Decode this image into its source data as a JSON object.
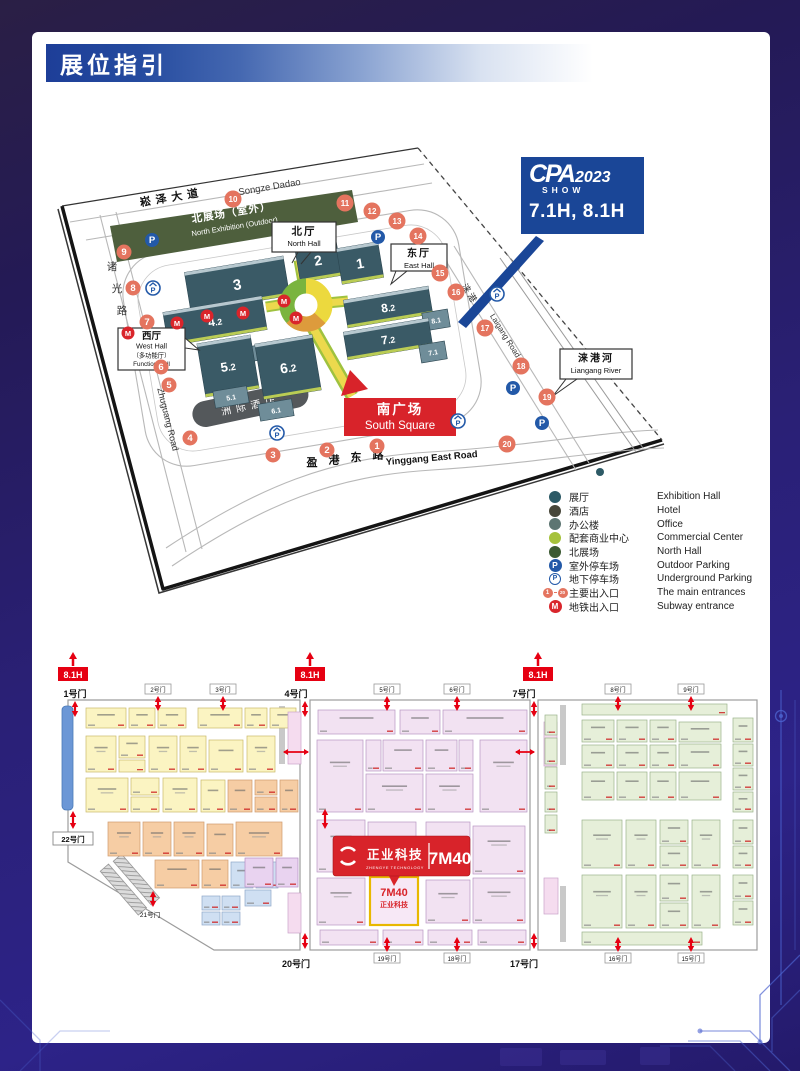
{
  "header": {
    "title": "展位指引"
  },
  "badge": {
    "brand": "CPA",
    "year": "2023",
    "show": "SHOW",
    "halls": "7.1H, 8.1H",
    "bg": "#1a4697"
  },
  "map": {
    "roads": {
      "songze_cn": "崧泽大道",
      "songze_en": "Songze Dadao",
      "zhuguang_cn": "诸光路",
      "zhuguang_en": "Zhuguang Road",
      "yinggang_cn": "盈港东路",
      "yinggang_en": "Yinggang East Road",
      "laigang_cn": "涞港路",
      "laigang_en": "Laigang Road"
    },
    "green_area": {
      "cn": "北展场（室外）",
      "en": "North Exhibition (Outdoor)"
    },
    "hotel": {
      "name": "洲际酒店"
    },
    "halls": [
      {
        "label": "3",
        "cx": 237,
        "cy": 284,
        "w": 100,
        "h": 40,
        "fs": 15,
        "small": false
      },
      {
        "label": "4.2",
        "cx": 215,
        "cy": 321,
        "w": 100,
        "h": 34,
        "fs": 12,
        "small": false
      },
      {
        "label": "4.1",
        "cx": 263,
        "cy": 352,
        "w": 40,
        "h": 15,
        "fs": 7,
        "small": true
      },
      {
        "label": "2",
        "cx": 318,
        "cy": 260,
        "w": 42,
        "h": 38,
        "fs": 14,
        "small": false
      },
      {
        "label": "1",
        "cx": 360,
        "cy": 263,
        "w": 42,
        "h": 36,
        "fs": 14,
        "small": false
      },
      {
        "label": "8.2",
        "cx": 388,
        "cy": 307,
        "w": 86,
        "h": 28,
        "fs": 12,
        "small": false
      },
      {
        "label": "8.1",
        "cx": 436,
        "cy": 320,
        "w": 26,
        "h": 18,
        "fs": 7,
        "small": true
      },
      {
        "label": "7.2",
        "cx": 388,
        "cy": 339,
        "w": 86,
        "h": 28,
        "fs": 12,
        "small": false
      },
      {
        "label": "7.1",
        "cx": 433,
        "cy": 352,
        "w": 26,
        "h": 18,
        "fs": 7,
        "small": true
      },
      {
        "label": "5.2",
        "cx": 228,
        "cy": 366,
        "w": 54,
        "h": 54,
        "fs": 13,
        "small": false
      },
      {
        "label": "6.2",
        "cx": 288,
        "cy": 367,
        "w": 58,
        "h": 56,
        "fs": 14,
        "small": false
      },
      {
        "label": "5.1",
        "cx": 231,
        "cy": 397,
        "w": 34,
        "h": 17,
        "fs": 7,
        "small": true
      },
      {
        "label": "6.1",
        "cx": 276,
        "cy": 410,
        "w": 34,
        "h": 17,
        "fs": 7,
        "small": true
      }
    ],
    "callouts": [
      {
        "id": "north",
        "cn": "北厅",
        "en": "North Hall",
        "x": 272,
        "y": 222,
        "w": 64,
        "h": 30
      },
      {
        "id": "east",
        "cn": "东厅",
        "en": "East Hall",
        "x": 391,
        "y": 244,
        "w": 56,
        "h": 27
      },
      {
        "id": "west",
        "cn": "西厅",
        "en": "West Hall",
        "sub_cn": "（多功能厅）",
        "sub_en": "Function Hall",
        "x": 118,
        "y": 328,
        "w": 67,
        "h": 42
      },
      {
        "id": "river",
        "cn": "涞港河",
        "en": "Liangang River",
        "x": 560,
        "y": 349,
        "w": 72,
        "h": 30
      }
    ],
    "south_square": {
      "cn": "南广场",
      "en": "South Square",
      "x": 344,
      "y": 398,
      "w": 112,
      "h": 38
    },
    "entrances": [
      {
        "n": "1",
        "x": 377,
        "y": 446
      },
      {
        "n": "2",
        "x": 327,
        "y": 450
      },
      {
        "n": "3",
        "x": 273,
        "y": 455
      },
      {
        "n": "4",
        "x": 190,
        "y": 438
      },
      {
        "n": "5",
        "x": 169,
        "y": 385
      },
      {
        "n": "6",
        "x": 161,
        "y": 367
      },
      {
        "n": "7",
        "x": 147,
        "y": 322
      },
      {
        "n": "8",
        "x": 133,
        "y": 288
      },
      {
        "n": "9",
        "x": 124,
        "y": 252
      },
      {
        "n": "10",
        "x": 233,
        "y": 199
      },
      {
        "n": "11",
        "x": 345,
        "y": 203
      },
      {
        "n": "12",
        "x": 372,
        "y": 211
      },
      {
        "n": "13",
        "x": 397,
        "y": 221
      },
      {
        "n": "14",
        "x": 418,
        "y": 236
      },
      {
        "n": "15",
        "x": 440,
        "y": 273
      },
      {
        "n": "16",
        "x": 456,
        "y": 292
      },
      {
        "n": "17",
        "x": 485,
        "y": 328
      },
      {
        "n": "18",
        "x": 521,
        "y": 366
      },
      {
        "n": "19",
        "x": 547,
        "y": 397
      },
      {
        "n": "20",
        "x": 507,
        "y": 444
      }
    ],
    "parking_outdoor": [
      [
        152,
        240
      ],
      [
        378,
        237
      ],
      [
        513,
        388
      ],
      [
        542,
        423
      ]
    ],
    "parking_underground": [
      [
        153,
        288
      ],
      [
        277,
        433
      ],
      [
        458,
        421
      ],
      [
        497,
        294
      ]
    ],
    "subway_points": [
      [
        128,
        333
      ],
      [
        177,
        323
      ],
      [
        207,
        316
      ],
      [
        243,
        313
      ],
      [
        284,
        301
      ],
      [
        296,
        318
      ]
    ]
  },
  "legend": {
    "rows": [
      {
        "icon": "dot",
        "color": "#2d5a66",
        "cn": "展厅",
        "en": "Exhibition Hall"
      },
      {
        "icon": "dot",
        "color": "#474639",
        "cn": "酒店",
        "en": "Hotel"
      },
      {
        "icon": "dot",
        "color": "#5d7572",
        "cn": "办公楼",
        "en": "Office"
      },
      {
        "icon": "dot",
        "color": "#a6c23c",
        "cn": "配套商业中心",
        "en": "Commercial Center"
      },
      {
        "icon": "dot",
        "color": "#3c5a33",
        "cn": "北展场",
        "en": "North Hall"
      },
      {
        "icon": "p-solid",
        "color": "#2359a8",
        "cn": "室外停车场",
        "en": "Outdoor Parking"
      },
      {
        "icon": "p-under",
        "color": "#2359a8",
        "cn": "地下停车场",
        "en": "Underground Parking"
      },
      {
        "icon": "entrance",
        "color": "#e4745f",
        "from": "1",
        "to": "20",
        "cn": "主要出入口",
        "en": "The main entrances"
      },
      {
        "icon": "subway",
        "color": "#d9252b",
        "glyph": "M",
        "cn": "地铁出入口",
        "en": "Subway entrance"
      }
    ]
  },
  "floorplan": {
    "hall_markers": [
      {
        "label": "8.1H",
        "x": 58
      },
      {
        "label": "8.1H",
        "x": 295
      },
      {
        "label": "8.1H",
        "x": 523
      }
    ],
    "gates": [
      {
        "label": "1号门",
        "x": 75,
        "big": true,
        "side": "top",
        "ax": 75
      },
      {
        "label": "2号门",
        "x": 158,
        "big": false,
        "side": "top"
      },
      {
        "label": "3号门",
        "x": 223,
        "big": false,
        "side": "top"
      },
      {
        "label": "4号门",
        "x": 296,
        "big": true,
        "side": "top",
        "ax": 305
      },
      {
        "label": "5号门",
        "x": 387,
        "big": false,
        "side": "top"
      },
      {
        "label": "6号门",
        "x": 457,
        "big": false,
        "side": "top"
      },
      {
        "label": "7号门",
        "x": 524,
        "big": true,
        "side": "top",
        "ax": 534
      },
      {
        "label": "8号门",
        "x": 618,
        "big": false,
        "side": "top"
      },
      {
        "label": "9号门",
        "x": 691,
        "big": false,
        "side": "top"
      },
      {
        "label": "22号门",
        "x": 73,
        "big": true,
        "side": "left",
        "ax": 73
      },
      {
        "label": "21号门",
        "x": 150,
        "big": false,
        "side": "diag",
        "ax": 153
      },
      {
        "label": "20号门",
        "x": 296,
        "big": true,
        "side": "bottom",
        "ax": 305
      },
      {
        "label": "19号门",
        "x": 387,
        "big": false,
        "side": "bottom"
      },
      {
        "label": "18号门",
        "x": 457,
        "big": false,
        "side": "bottom"
      },
      {
        "label": "17号门",
        "x": 524,
        "big": true,
        "side": "bottom",
        "ax": 534
      },
      {
        "label": "16号门",
        "x": 618,
        "big": false,
        "side": "bottom"
      },
      {
        "label": "15号门",
        "x": 691,
        "big": false,
        "side": "bottom"
      }
    ],
    "banner": {
      "cn": "正业科技",
      "en": "ZHENGYE TECHNOLOGY",
      "booth": "7M40"
    },
    "highlight": {
      "booth": "7M40",
      "name": "正业科技"
    },
    "palette": {
      "yellow": {
        "f": "#fbf4c2",
        "s": "#c9b96a"
      },
      "salmon": {
        "f": "#f6cda4",
        "s": "#cf9a6d"
      },
      "lavender": {
        "f": "#f2e2f2",
        "s": "#b796c2"
      },
      "green": {
        "f": "#e6efd9",
        "s": "#9ab38a"
      },
      "blue": {
        "f": "#cfdff2",
        "s": "#8fa8c8"
      },
      "purple": {
        "f": "#e9d3f0",
        "s": "#b48cc2"
      },
      "pinkstrip": {
        "f": "#f5dcef",
        "s": "#c9a3c9"
      }
    },
    "blocks": {
      "yellow": [
        [
          86,
          708,
          40,
          20
        ],
        [
          129,
          708,
          26,
          20
        ],
        [
          158,
          708,
          28,
          20
        ],
        [
          198,
          708,
          44,
          20
        ],
        [
          245,
          708,
          22,
          20
        ],
        [
          270,
          708,
          26,
          20
        ],
        [
          86,
          736,
          30,
          36
        ],
        [
          119,
          736,
          26,
          22
        ],
        [
          119,
          760,
          26,
          12
        ],
        [
          149,
          736,
          28,
          36
        ],
        [
          180,
          736,
          26,
          36
        ],
        [
          209,
          740,
          34,
          32
        ],
        [
          247,
          736,
          28,
          36
        ],
        [
          86,
          778,
          42,
          34
        ],
        [
          131,
          778,
          28,
          17
        ],
        [
          131,
          797,
          28,
          15
        ],
        [
          163,
          778,
          34,
          34
        ],
        [
          201,
          780,
          24,
          32
        ]
      ],
      "salmon": [
        [
          228,
          780,
          24,
          32
        ],
        [
          255,
          780,
          22,
          15
        ],
        [
          255,
          797,
          22,
          15
        ],
        [
          280,
          780,
          18,
          32
        ],
        [
          108,
          822,
          32,
          34
        ],
        [
          143,
          822,
          28,
          34
        ],
        [
          174,
          822,
          30,
          34
        ],
        [
          207,
          824,
          26,
          32
        ],
        [
          236,
          822,
          46,
          34
        ],
        [
          155,
          860,
          44,
          28
        ],
        [
          202,
          860,
          26,
          28
        ]
      ],
      "blue": [
        [
          231,
          862,
          22,
          26
        ],
        [
          256,
          862,
          22,
          26
        ],
        [
          202,
          896,
          18,
          14
        ],
        [
          222,
          896,
          18,
          14
        ],
        [
          202,
          912,
          18,
          13
        ],
        [
          222,
          912,
          18,
          13
        ],
        [
          245,
          890,
          26,
          16
        ]
      ],
      "purple": [
        [
          245,
          858,
          28,
          29
        ],
        [
          276,
          858,
          22,
          29
        ]
      ],
      "pinkstrip": [
        [
          288,
          712,
          13,
          52
        ],
        [
          288,
          893,
          13,
          40
        ],
        [
          544,
          722,
          13,
          44
        ],
        [
          544,
          878,
          14,
          36
        ]
      ],
      "lavender": [
        [
          318,
          710,
          77,
          24
        ],
        [
          400,
          710,
          40,
          24
        ],
        [
          443,
          710,
          84,
          24
        ],
        [
          317,
          740,
          46,
          72
        ],
        [
          366,
          740,
          15,
          31
        ],
        [
          383,
          740,
          40,
          31
        ],
        [
          366,
          774,
          57,
          38
        ],
        [
          426,
          740,
          31,
          31
        ],
        [
          459,
          740,
          14,
          31
        ],
        [
          426,
          774,
          47,
          38
        ],
        [
          480,
          740,
          47,
          72
        ],
        [
          317,
          820,
          48,
          52
        ],
        [
          368,
          822,
          48,
          50
        ],
        [
          426,
          822,
          44,
          50
        ],
        [
          473,
          826,
          52,
          48
        ],
        [
          317,
          878,
          48,
          47
        ],
        [
          426,
          880,
          44,
          43
        ],
        [
          473,
          878,
          52,
          45
        ],
        [
          320,
          930,
          58,
          15
        ],
        [
          383,
          930,
          40,
          15
        ],
        [
          428,
          930,
          44,
          15
        ],
        [
          478,
          930,
          48,
          15
        ]
      ],
      "green": [
        [
          582,
          704,
          145,
          11
        ],
        [
          582,
          720,
          32,
          22
        ],
        [
          617,
          720,
          30,
          22
        ],
        [
          650,
          720,
          26,
          22
        ],
        [
          679,
          722,
          42,
          20
        ],
        [
          582,
          745,
          32,
          23
        ],
        [
          617,
          745,
          30,
          23
        ],
        [
          650,
          745,
          26,
          23
        ],
        [
          679,
          744,
          42,
          24
        ],
        [
          582,
          772,
          32,
          28
        ],
        [
          617,
          772,
          30,
          28
        ],
        [
          650,
          772,
          26,
          28
        ],
        [
          679,
          772,
          42,
          28
        ],
        [
          582,
          820,
          40,
          48
        ],
        [
          626,
          820,
          30,
          48
        ],
        [
          660,
          820,
          28,
          24
        ],
        [
          660,
          846,
          28,
          22
        ],
        [
          692,
          820,
          28,
          48
        ],
        [
          582,
          875,
          40,
          53
        ],
        [
          626,
          875,
          30,
          53
        ],
        [
          660,
          875,
          28,
          26
        ],
        [
          660,
          903,
          28,
          25
        ],
        [
          692,
          875,
          28,
          53
        ],
        [
          582,
          932,
          120,
          13
        ],
        [
          545,
          715,
          12,
          20
        ],
        [
          545,
          738,
          12,
          26
        ],
        [
          545,
          767,
          12,
          22
        ],
        [
          545,
          792,
          12,
          20
        ],
        [
          545,
          815,
          12,
          18
        ],
        [
          733,
          718,
          20,
          24
        ],
        [
          733,
          744,
          20,
          22
        ],
        [
          733,
          768,
          20,
          22
        ],
        [
          733,
          792,
          20,
          20
        ],
        [
          733,
          820,
          20,
          24
        ],
        [
          733,
          846,
          20,
          22
        ],
        [
          733,
          875,
          20,
          24
        ],
        [
          733,
          901,
          20,
          24
        ]
      ]
    }
  }
}
